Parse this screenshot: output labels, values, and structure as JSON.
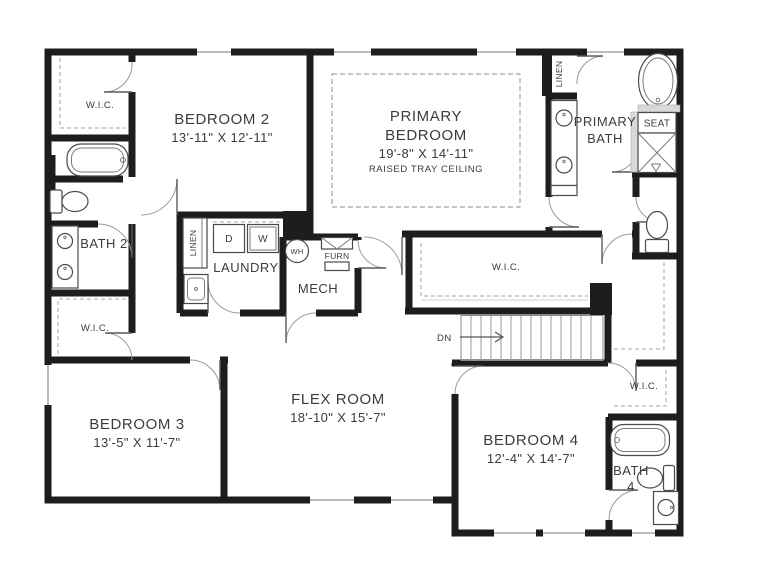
{
  "plan": {
    "type": "second-floor residential floor plan",
    "colors": {
      "wall": "#1d1d1d",
      "fixture_line": "#4a4a4a",
      "dashed_shelving": "#a3a3a3",
      "text": "#3c3c3c",
      "background": "#ffffff"
    },
    "rooms": {
      "wic_top_left": "W.I.C.",
      "bedroom2_name": "BEDROOM 2",
      "bedroom2_dims": "13'-11\" X 12'-11\"",
      "primary_line1": "PRIMARY",
      "primary_line2": "BEDROOM",
      "primary_dims": "19'-8\" X 14'-11\"",
      "primary_note": "RAISED TRAY CEILING",
      "linen_primary": "LINEN",
      "primary_bath_line1": "PRIMARY",
      "primary_bath_line2": "BATH",
      "seat": "SEAT",
      "bath2": "BATH 2",
      "linen_laundry": "LINEN",
      "dryer": "D",
      "washer": "W",
      "laundry": "LAUNDRY",
      "water_heater": "WH",
      "furnace": "FURN",
      "mech": "MECH",
      "primary_wic": "W.I.C.",
      "stairs_dn": "DN",
      "wic_left": "W.I.C.",
      "bedroom3_name": "BEDROOM 3",
      "bedroom3_dims": "13'-5\" X 11'-7\"",
      "flex_name": "FLEX ROOM",
      "flex_dims": "18'-10\" X 15'-7\"",
      "bedroom4_name": "BEDROOM 4",
      "bedroom4_dims": "12'-4\" X 14'-7\"",
      "wic_bedroom4": "W.I.C.",
      "bath4_line1": "BATH",
      "bath4_line2": "4"
    }
  }
}
